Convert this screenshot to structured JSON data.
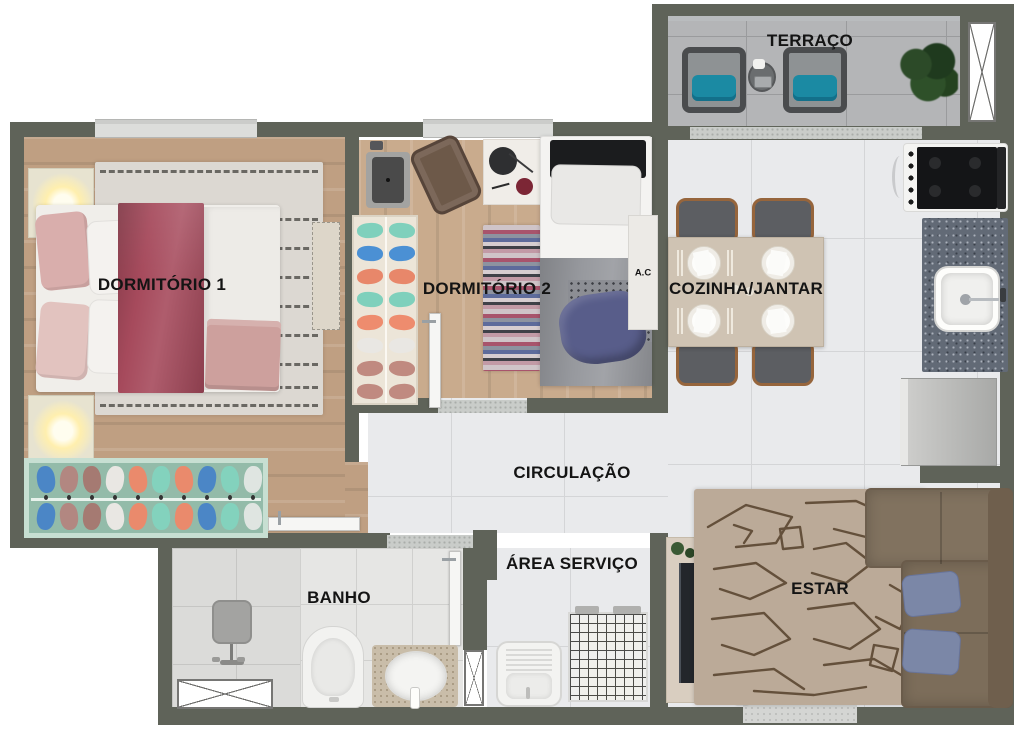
{
  "plan": {
    "type": "apartment-floor-plan",
    "rooms": [
      {
        "key": "terraco",
        "label": "TERRAÇO"
      },
      {
        "key": "dormitorio-1",
        "label": "DORMITÓRIO 1"
      },
      {
        "key": "dormitorio-2",
        "label": "DORMITÓRIO 2"
      },
      {
        "key": "cozinha-jantar",
        "label": "COZINHA/JANTAR"
      },
      {
        "key": "circulacao",
        "label": "CIRCULAÇÃO"
      },
      {
        "key": "area-servico",
        "label": "ÁREA SERVIÇO"
      },
      {
        "key": "banho",
        "label": "BANHO"
      },
      {
        "key": "estar",
        "label": "ESTAR"
      }
    ],
    "annotations": [
      {
        "key": "ac-unit",
        "label": "A.C"
      }
    ],
    "colors": {
      "wall": "#5f6359",
      "wood_floor": "#c0a083",
      "tile_floor": "#e9eaec",
      "terrace_floor": "#b4b5b7",
      "granite_counter": "#626a76",
      "accent_teal_cushion": "#1b8aa3",
      "bed_blanket_maroon": "#a64a5c",
      "bed_blanket_blue": "#585d8a",
      "sofa_brown": "#7c6d5a",
      "pillow_blue": "#7b87a7",
      "estar_rug": "#bbaa98",
      "closet_mint": "#93bba9"
    }
  }
}
